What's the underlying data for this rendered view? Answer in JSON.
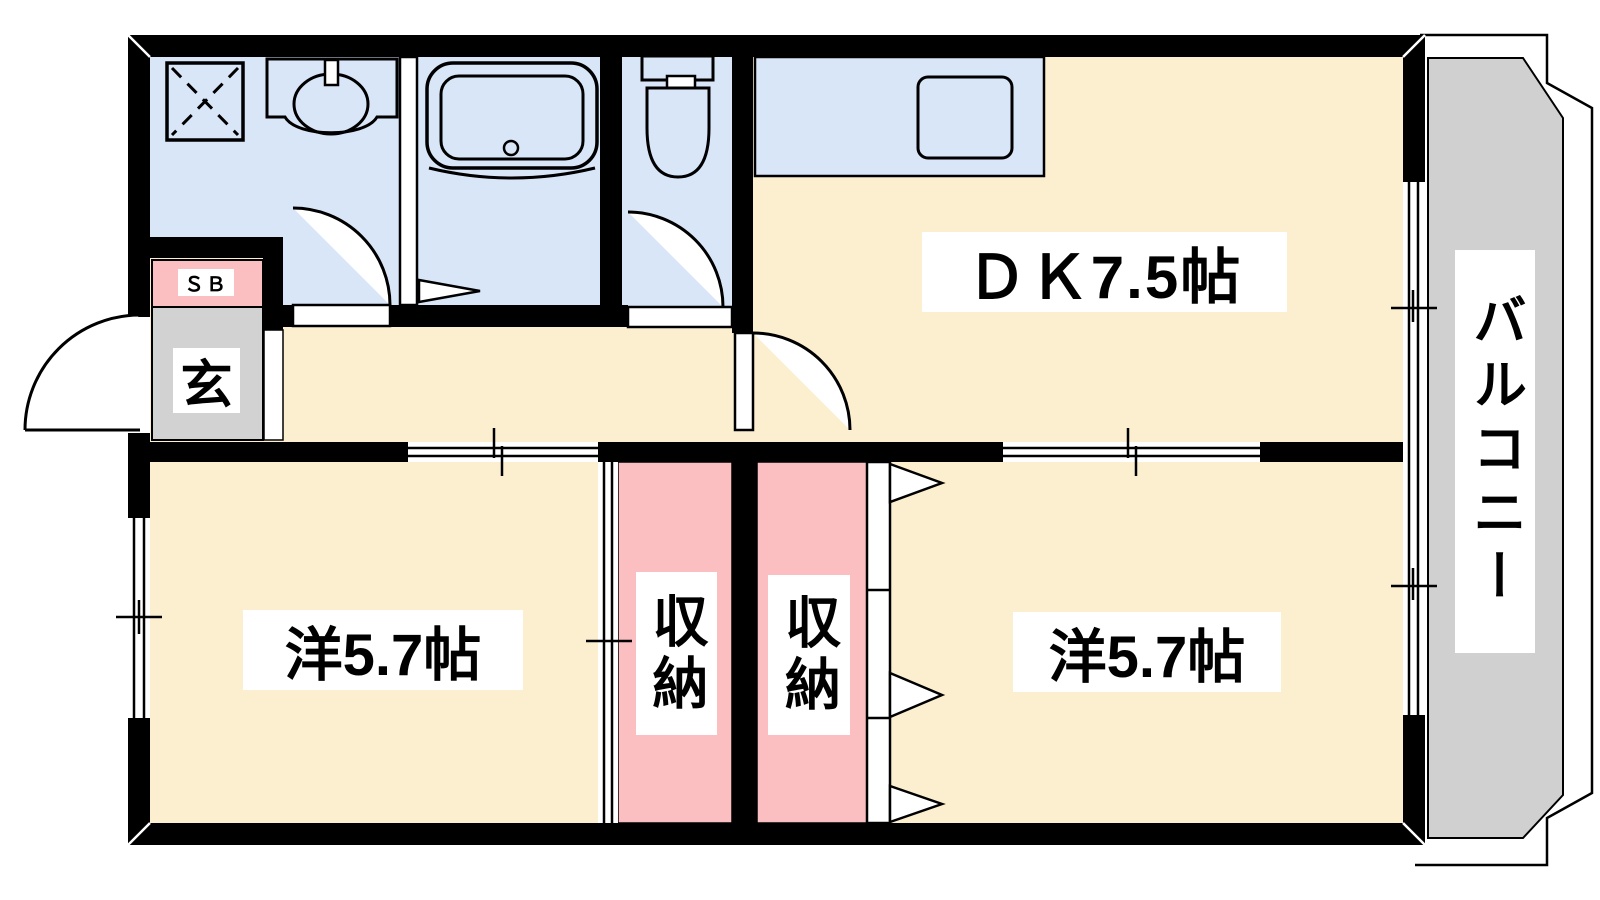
{
  "plan": {
    "rooms": {
      "dining_kitchen": {
        "label": "ＤＫ7.5帖"
      },
      "bedroom_left": {
        "label": "洋5.7帖"
      },
      "bedroom_right": {
        "label": "洋5.7帖"
      },
      "closet_left": {
        "label": "収納"
      },
      "closet_right": {
        "label": "収納"
      },
      "entrance": {
        "label": "玄"
      },
      "shoebox": {
        "label": "ＳＢ"
      },
      "balcony": {
        "label": "バルコニー"
      }
    },
    "colors": {
      "floor": "#FBEFD0",
      "wet_area": "#D8E6F8",
      "closet": "#FBBFC2",
      "entrance_floor": "#D2D2D2",
      "balcony_floor": "#D0D0D0",
      "wall": "#000000",
      "label_background": "#FFFFFF"
    },
    "fixtures": [
      "washer-pan",
      "washbasin",
      "bathtub",
      "toilet",
      "kitchen-sink"
    ]
  }
}
